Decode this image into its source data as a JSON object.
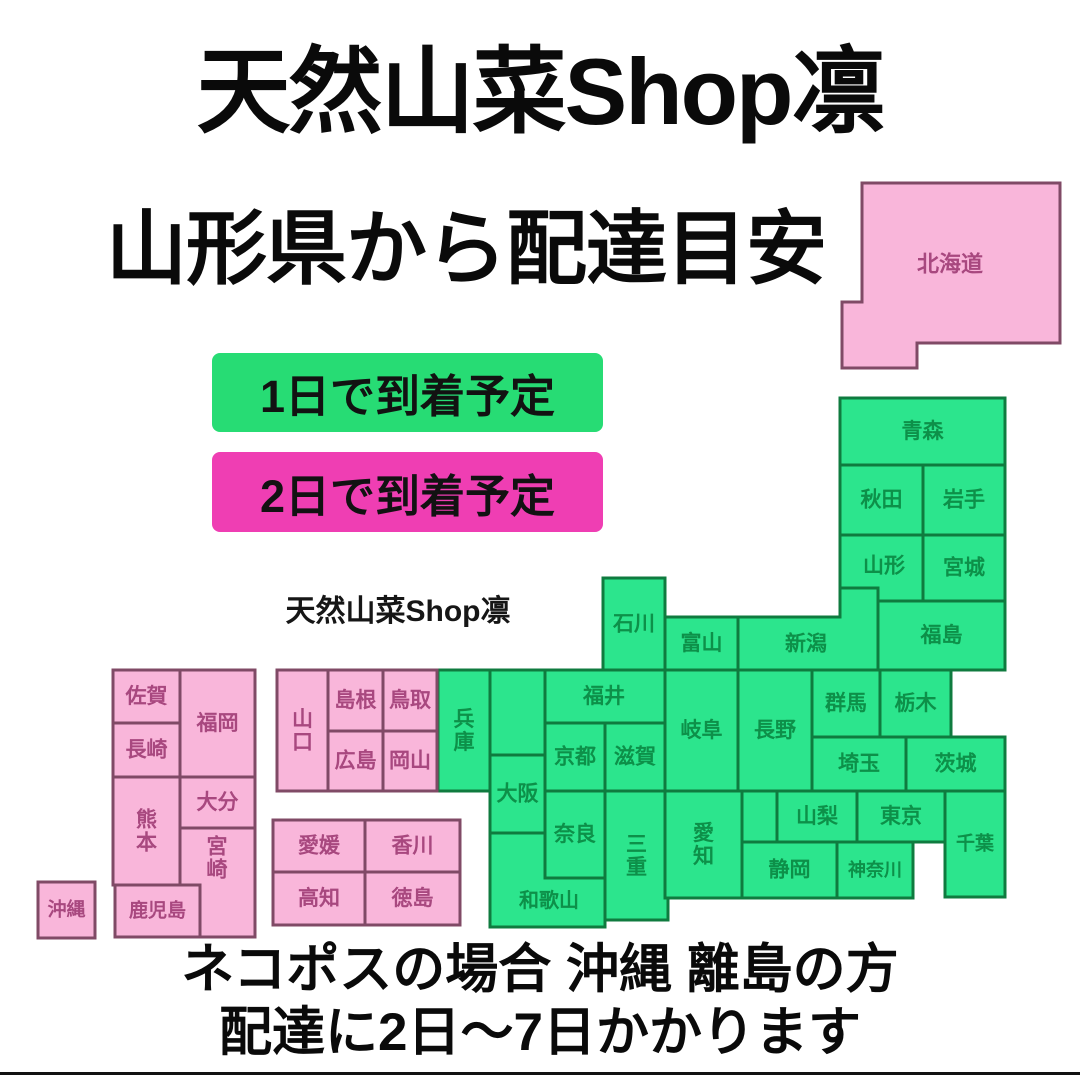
{
  "title": "天然山菜Shop凛",
  "subtitle": "山形県から配達目安",
  "watermark": "天然山菜Shop凛",
  "legend": [
    {
      "id": "one-day",
      "label": "1日で到着予定",
      "color": "#27dc74"
    },
    {
      "id": "two-day",
      "label": "2日で到着予定",
      "color": "#ef3eb3"
    }
  ],
  "footer": {
    "line1": "ネコポスの場合 沖縄 離島の方",
    "line2": "配達に2日〜7日かかります"
  },
  "map": {
    "colors": {
      "green": {
        "fill": "#2ce58d",
        "stroke": "#0f7b3f",
        "label": "#0d9049"
      },
      "pink": {
        "fill": "#f9b6da",
        "stroke": "#804a66",
        "label": "#a8487f"
      }
    },
    "prefectures": [
      {
        "id": "hokkaido",
        "label": "北海道",
        "color": "pink",
        "points": [
          [
            862,
            183
          ],
          [
            1060,
            183
          ],
          [
            1060,
            343
          ],
          [
            917,
            343
          ],
          [
            917,
            368
          ],
          [
            842,
            368
          ],
          [
            842,
            302
          ],
          [
            862,
            302
          ]
        ],
        "label_pos": [
          950,
          264
        ],
        "font": 22
      },
      {
        "id": "aomori",
        "label": "青森",
        "color": "green",
        "rect": [
          840,
          398,
          165,
          67
        ]
      },
      {
        "id": "akita",
        "label": "秋田",
        "color": "green",
        "rect": [
          840,
          465,
          83,
          70
        ]
      },
      {
        "id": "iwate",
        "label": "岩手",
        "color": "green",
        "rect": [
          923,
          465,
          82,
          70
        ]
      },
      {
        "id": "yamagata",
        "label": "山形",
        "color": "green",
        "points": [
          [
            840,
            535
          ],
          [
            923,
            535
          ],
          [
            923,
            601
          ],
          [
            878,
            601
          ],
          [
            878,
            588
          ],
          [
            840,
            588
          ]
        ],
        "label_pos": [
          884,
          566
        ]
      },
      {
        "id": "miyagi",
        "label": "宮城",
        "color": "green",
        "rect": [
          923,
          535,
          82,
          66
        ]
      },
      {
        "id": "fukushima",
        "label": "福島",
        "color": "green",
        "rect": [
          878,
          601,
          127,
          69
        ]
      },
      {
        "id": "niigata",
        "label": "新潟",
        "color": "green",
        "points": [
          [
            840,
            588
          ],
          [
            878,
            588
          ],
          [
            878,
            670
          ],
          [
            738,
            670
          ],
          [
            738,
            617
          ],
          [
            840,
            617
          ]
        ],
        "label_pos": [
          806,
          644
        ]
      },
      {
        "id": "toyama",
        "label": "富山",
        "color": "green",
        "rect": [
          665,
          617,
          73,
          53
        ]
      },
      {
        "id": "ishikawa",
        "label": "石川",
        "color": "green",
        "rect": [
          603,
          578,
          62,
          92
        ]
      },
      {
        "id": "fukui",
        "label": "福井",
        "color": "green",
        "rect": [
          543,
          670,
          122,
          53
        ]
      },
      {
        "id": "gunma",
        "label": "群馬",
        "color": "green",
        "rect": [
          812,
          670,
          68,
          67
        ]
      },
      {
        "id": "tochigi",
        "label": "栃木",
        "color": "green",
        "rect": [
          880,
          670,
          71,
          67
        ]
      },
      {
        "id": "saitama",
        "label": "埼玉",
        "color": "green",
        "rect": [
          812,
          737,
          94,
          54
        ]
      },
      {
        "id": "ibaraki",
        "label": "茨城",
        "color": "green",
        "rect": [
          906,
          737,
          99,
          54
        ]
      },
      {
        "id": "nagano",
        "label": "長野",
        "color": "green",
        "rect": [
          738,
          670,
          74,
          121
        ]
      },
      {
        "id": "gifu",
        "label": "岐阜",
        "color": "green",
        "rect": [
          665,
          670,
          73,
          121
        ]
      },
      {
        "id": "kyoto-north",
        "label": "",
        "color": "green",
        "rect": [
          490,
          670,
          55,
          85
        ]
      },
      {
        "id": "hyogo",
        "label": "兵庫",
        "color": "green",
        "rect": [
          438,
          670,
          52,
          121
        ],
        "vertical": true
      },
      {
        "id": "kyoto",
        "label": "京都",
        "color": "green",
        "rect": [
          545,
          723,
          60,
          68
        ]
      },
      {
        "id": "shiga",
        "label": "滋賀",
        "color": "green",
        "rect": [
          605,
          723,
          60,
          68
        ]
      },
      {
        "id": "osaka",
        "label": "大阪",
        "color": "green",
        "rect": [
          490,
          755,
          55,
          78
        ]
      },
      {
        "id": "nara",
        "label": "奈良",
        "color": "green",
        "rect": [
          545,
          791,
          60,
          87
        ]
      },
      {
        "id": "mie",
        "label": "三重",
        "color": "green",
        "rect": [
          605,
          791,
          63,
          129
        ],
        "vertical": true
      },
      {
        "id": "wakayama",
        "label": "和歌山",
        "color": "green",
        "points": [
          [
            490,
            833
          ],
          [
            545,
            833
          ],
          [
            545,
            878
          ],
          [
            605,
            878
          ],
          [
            605,
            927
          ],
          [
            490,
            927
          ]
        ],
        "label_pos": [
          549,
          901
        ],
        "font": 20
      },
      {
        "id": "aichi",
        "label": "愛知",
        "color": "green",
        "rect": [
          665,
          791,
          77,
          107
        ],
        "vertical": true
      },
      {
        "id": "shizuoka-north",
        "label": "",
        "color": "green",
        "rect": [
          742,
          791,
          35,
          51
        ]
      },
      {
        "id": "yamanashi",
        "label": "山梨",
        "color": "green",
        "rect": [
          777,
          791,
          80,
          51
        ]
      },
      {
        "id": "tokyo",
        "label": "東京",
        "color": "green",
        "rect": [
          857,
          791,
          88,
          51
        ]
      },
      {
        "id": "shizuoka",
        "label": "静岡",
        "color": "green",
        "rect": [
          742,
          842,
          95,
          56
        ]
      },
      {
        "id": "kanagawa",
        "label": "神奈川",
        "color": "green",
        "rect": [
          837,
          842,
          76,
          56
        ],
        "font": 18
      },
      {
        "id": "chiba",
        "label": "千葉",
        "color": "green",
        "rect": [
          945,
          791,
          60,
          106
        ],
        "font": 19
      },
      {
        "id": "yamaguchi",
        "label": "山口",
        "color": "pink",
        "rect": [
          277,
          670,
          51,
          121
        ],
        "vertical": true
      },
      {
        "id": "shimane",
        "label": "島根",
        "color": "pink",
        "rect": [
          328,
          670,
          55,
          61
        ]
      },
      {
        "id": "tottori",
        "label": "鳥取",
        "color": "pink",
        "rect": [
          383,
          670,
          54,
          61
        ]
      },
      {
        "id": "hiroshima",
        "label": "広島",
        "color": "pink",
        "rect": [
          328,
          731,
          55,
          60
        ]
      },
      {
        "id": "okayama",
        "label": "岡山",
        "color": "pink",
        "rect": [
          383,
          731,
          54,
          60
        ]
      },
      {
        "id": "ehime",
        "label": "愛媛",
        "color": "pink",
        "rect": [
          273,
          820,
          92,
          52
        ]
      },
      {
        "id": "kagawa",
        "label": "香川",
        "color": "pink",
        "rect": [
          365,
          820,
          95,
          52
        ]
      },
      {
        "id": "kochi",
        "label": "高知",
        "color": "pink",
        "rect": [
          273,
          872,
          92,
          53
        ]
      },
      {
        "id": "tokushima",
        "label": "徳島",
        "color": "pink",
        "rect": [
          365,
          872,
          95,
          53
        ]
      },
      {
        "id": "saga",
        "label": "佐賀",
        "color": "pink",
        "rect": [
          113,
          670,
          67,
          53
        ]
      },
      {
        "id": "fukuoka",
        "label": "福岡",
        "color": "pink",
        "rect": [
          180,
          670,
          75,
          107
        ]
      },
      {
        "id": "nagasaki",
        "label": "長崎",
        "color": "pink",
        "rect": [
          113,
          723,
          67,
          54
        ]
      },
      {
        "id": "kumamoto",
        "label": "熊本",
        "color": "pink",
        "rect": [
          113,
          777,
          67,
          108
        ],
        "vertical": true
      },
      {
        "id": "oita",
        "label": "大分",
        "color": "pink",
        "rect": [
          180,
          777,
          75,
          51
        ]
      },
      {
        "id": "miyazaki",
        "label": "宮崎",
        "color": "pink",
        "rect": [
          180,
          828,
          75,
          109
        ],
        "vertical": true,
        "label_pos": [
          217,
          858
        ]
      },
      {
        "id": "kagoshima",
        "label": "鹿児島",
        "color": "pink",
        "rect": [
          115,
          885,
          85,
          52
        ],
        "font": 19
      },
      {
        "id": "okinawa",
        "label": "沖縄",
        "color": "pink",
        "rect": [
          38,
          882,
          57,
          56
        ],
        "font": 19
      }
    ]
  }
}
